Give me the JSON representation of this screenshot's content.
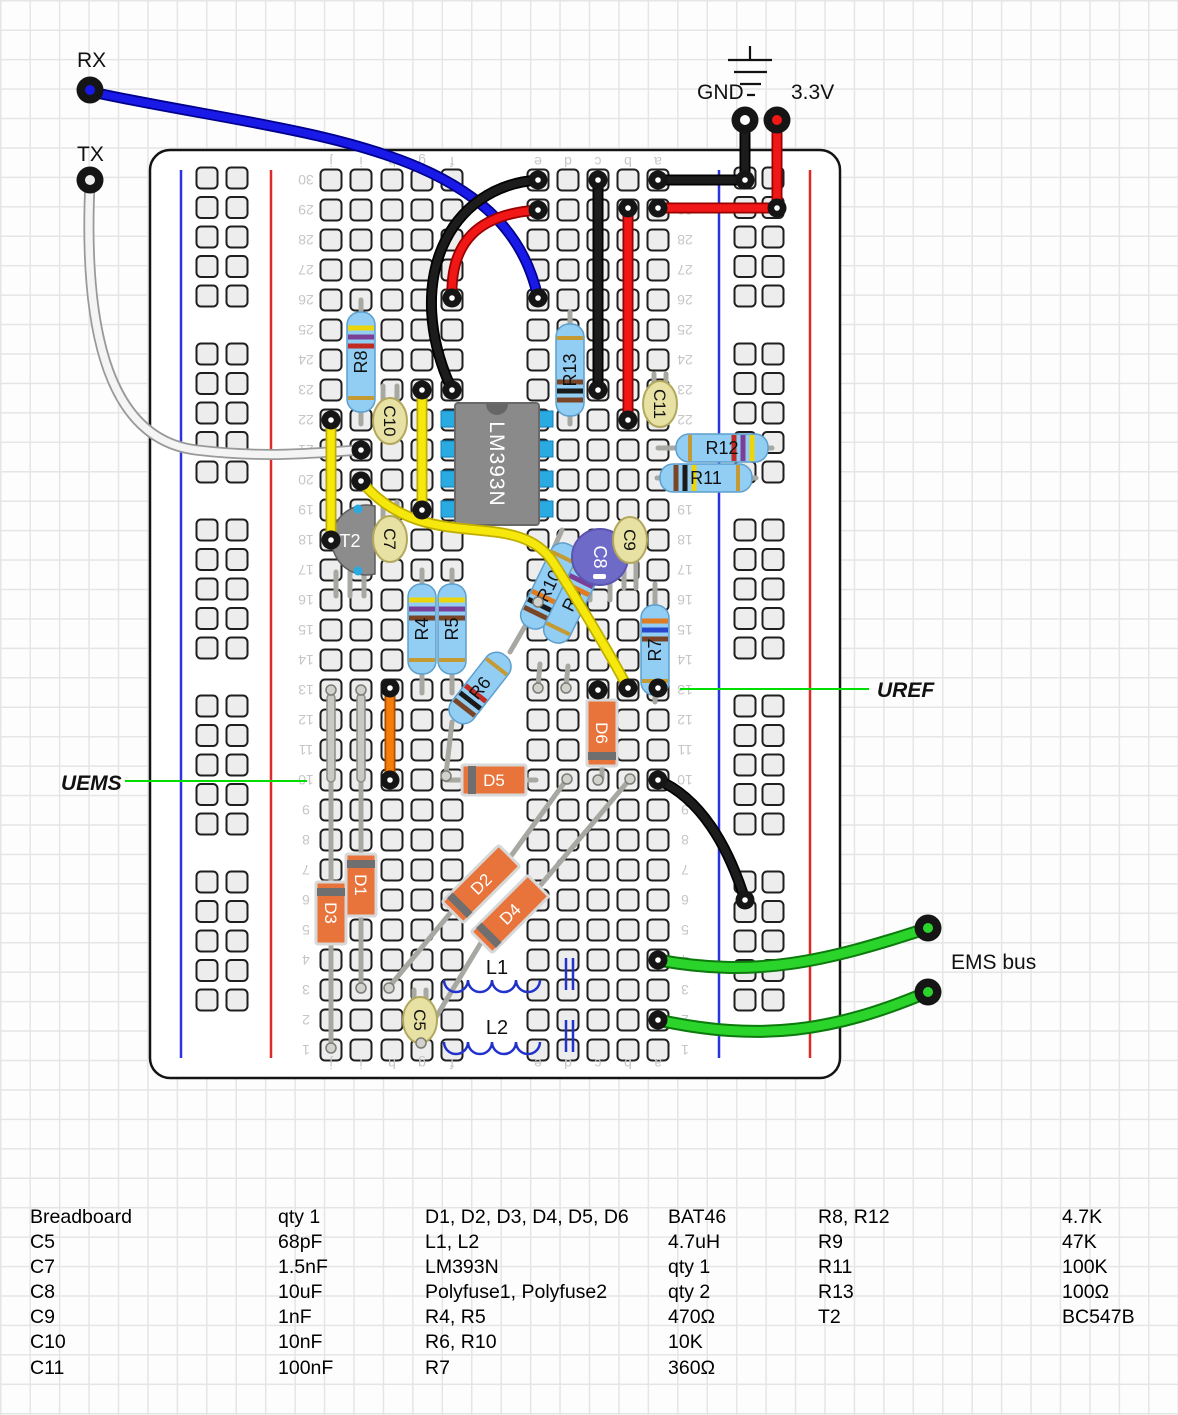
{
  "pins": {
    "rx": "RX",
    "tx": "TX",
    "gnd": "GND",
    "v33": "3.3V"
  },
  "annotations": {
    "uref": "UREF",
    "uems": "UEMS",
    "ems_bus": "EMS bus"
  },
  "board": {
    "row_min": 1,
    "row_max": 30,
    "column_letters": [
      "j",
      "i",
      "h",
      "g",
      "f",
      "e",
      "d",
      "c",
      "b",
      "a"
    ]
  },
  "components": {
    "ic": "LM393N",
    "t2": "T2",
    "r4": "R4",
    "r5": "R5",
    "r6": "R6",
    "r7": "R7",
    "r8": "R8",
    "r9": "R9",
    "r10": "R10",
    "r11": "R11",
    "r12": "R12",
    "r13": "R13",
    "c5": "C5",
    "c7": "C7",
    "c8": "C8",
    "c9": "C9",
    "c10": "C10",
    "c11": "C11",
    "d1": "D1",
    "d2": "D2",
    "d3": "D3",
    "d4": "D4",
    "d5": "D5",
    "d6": "D6",
    "l1": "L1",
    "l2": "L2"
  },
  "colors": {
    "wire_blue": "#1919e8",
    "wire_red": "#f21717",
    "wire_black": "#1c1c1c",
    "wire_yellow": "#f6e80c",
    "wire_green": "#2bd42b",
    "wire_white": "#f4f4f4",
    "wire_orange": "#f57d0a",
    "annotation_green": "#00dd00",
    "resistor_body": "#92cdf4",
    "diode_body": "#e8743c",
    "capacitor_tan": "#e7e1a4",
    "capacitor_purple": "#6e6ac8",
    "ic_gray": "#8a8a8a",
    "pin_cyan": "#29abe2",
    "rail_blue": "#2a35e0",
    "rail_red": "#e02a2a"
  },
  "parts_table": {
    "rows": [
      [
        "Breadboard",
        "qty 1",
        "D1, D2, D3, D4, D5, D6",
        "BAT46",
        "R8, R12",
        "4.7K"
      ],
      [
        "C5",
        "68pF",
        "L1, L2",
        "4.7uH",
        "R9",
        "47K"
      ],
      [
        "C7",
        "1.5nF",
        "LM393N",
        "qty 1",
        "R11",
        "100K"
      ],
      [
        "C8",
        "10uF",
        "Polyfuse1, Polyfuse2",
        "qty 2",
        "R13",
        "100Ω"
      ],
      [
        "C9",
        "1nF",
        "R4, R5",
        "470Ω",
        "T2",
        "BC547B"
      ],
      [
        "C10",
        "10nF",
        "R6, R10",
        "10K",
        "",
        ""
      ],
      [
        "C11",
        "100nF",
        "R7",
        "360Ω",
        "",
        ""
      ]
    ]
  }
}
